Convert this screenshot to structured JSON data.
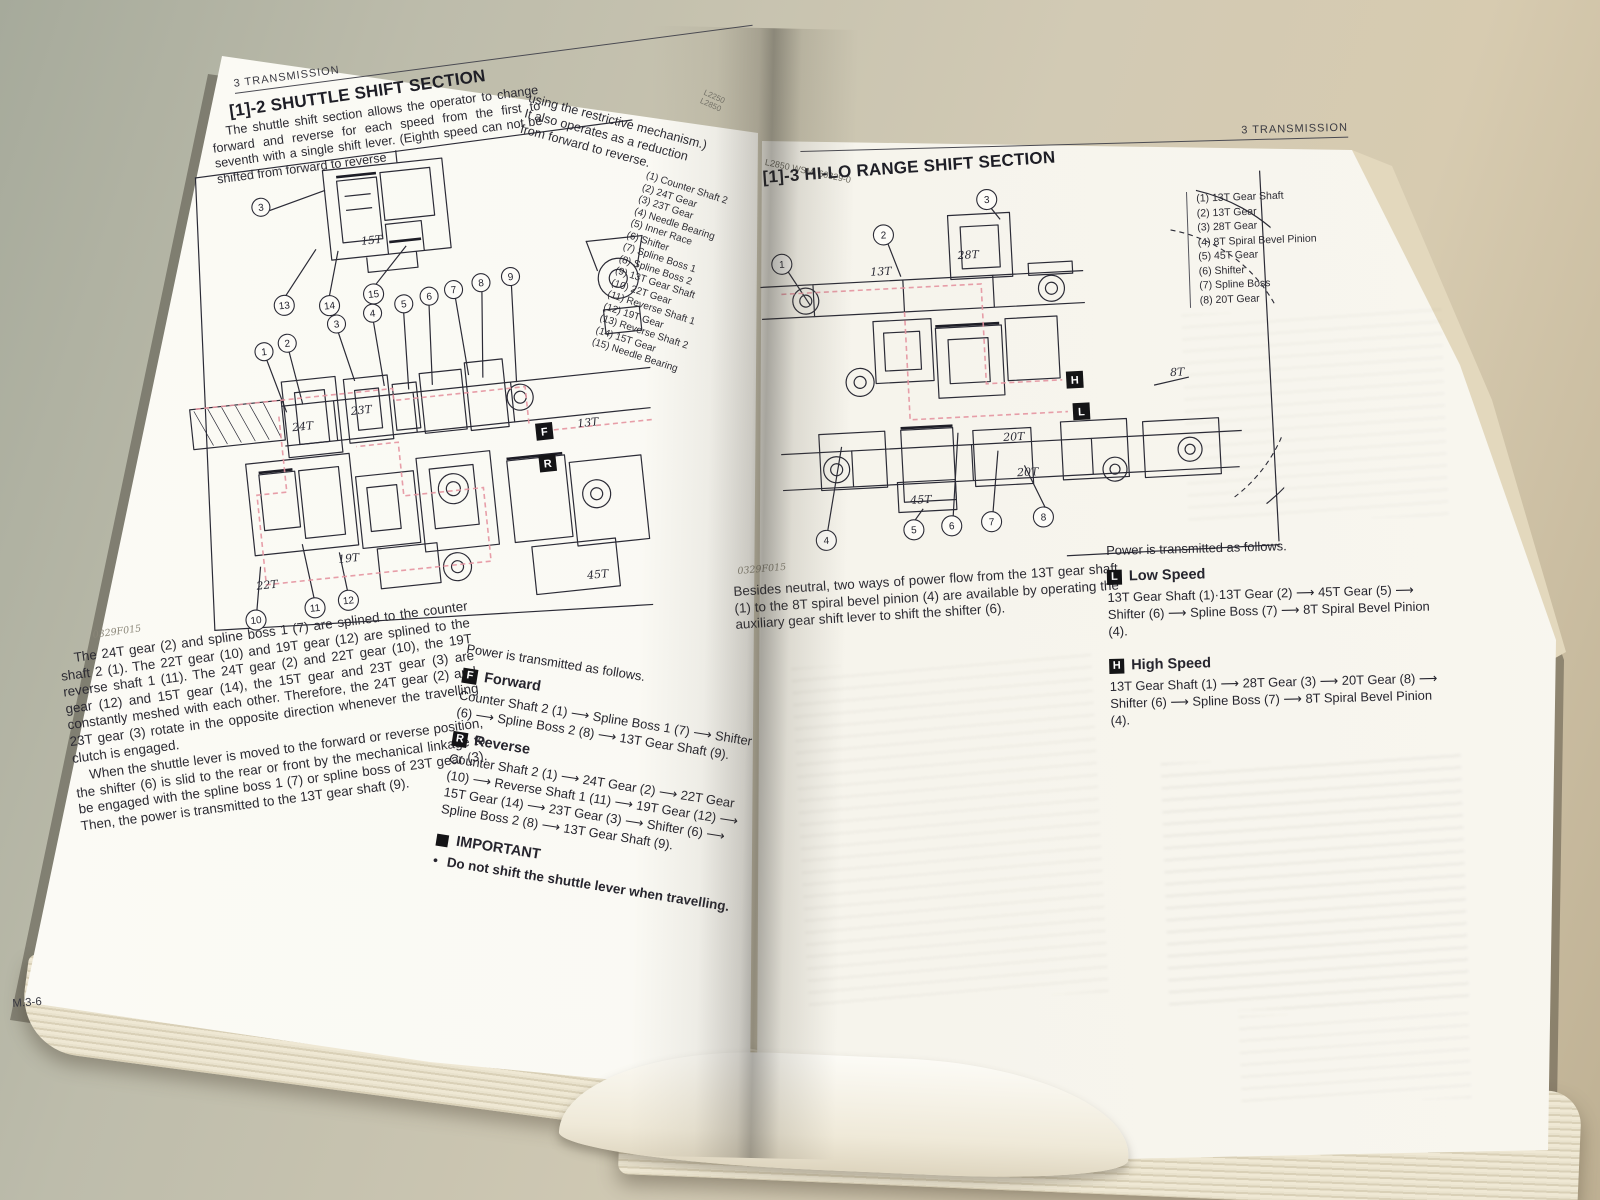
{
  "colors": {
    "table": "#c9c2af",
    "page": "#f8f6f0",
    "ink": "#2b2b36",
    "flow_red": "#e493a0",
    "badge_bg": "#141416"
  },
  "left_page": {
    "running_header": "3  TRANSMISSION",
    "section_title": "[1]-2 SHUTTLE SHIFT SECTION",
    "intro_col1": "The shuttle shift section allows the operator to change forward and reverse for each speed from the first to seventh with a single shift lever. (Eighth speed can not be shifted from forward to reverse",
    "intro_col2": "using the restrictive mechanism.)\nIt also operates as a reduction\nfrom forward to reverse.",
    "spine_fragment_1": "L2250",
    "spine_fragment_2": "L2850",
    "parts_list": [
      "(1)  Counter Shaft 2",
      "(2)  24T Gear",
      "(3)  23T Gear",
      "(4)  Needle Bearing",
      "(5)  Inner Race",
      "(6)  Shifter",
      "(7)  Spline Boss 1",
      "(8)  Spline Boss 2",
      "(9)  13T Gear Shaft",
      "(10)  22T Gear",
      "(11)  Reverse Shaft 1",
      "(12)  19T Gear",
      "(13)  Reverse Shaft 2",
      "(14)  15T Gear",
      "(15)  Needle Bearing"
    ],
    "body_p1": "The 24T gear (2) and spline boss 1 (7) are splined to the counter shaft 2 (1). The 22T gear (10) and 19T gear (12) are splined to the reverse shaft 1 (11). The 24T gear (2) and 22T gear (10), the 19T gear (12) and 15T gear (14), the 15T gear and 23T gear (3) are constantly meshed with each other. Therefore, the 24T gear (2) and 23T gear (3) rotate in the opposite direction whenever the travelling clutch is engaged.",
    "body_p2": "When the shuttle lever is moved to the forward or reverse position, the shifter (6) is slid to the rear or front by the mechanical linkage to be engaged with the spline boss 1 (7) or spline boss of 23T gear (3). Then, the power is transmitted to the 13T gear shaft (9).",
    "power_intro": "Power is transmitted as follows.",
    "forward": {
      "badge": "F",
      "title": "Forward",
      "chain": "Counter Shaft 2 (1) ⟶ Spline Boss 1 (7) ⟶ Shifter (6) ⟶ Spline Boss 2 (8) ⟶ 13T Gear Shaft (9)."
    },
    "reverse": {
      "badge": "R",
      "title": "Reverse",
      "chain": "Counter Shaft 2 (1) ⟶ 24T Gear (2) ⟶ 22T Gear (10) ⟶ Reverse Shaft 1 (11) ⟶ 19T Gear (12) ⟶ 15T Gear (14) ⟶ 23T Gear (3) ⟶ Shifter (6) ⟶ Spline Boss 2 (8) ⟶ 13T Gear Shaft (9)."
    },
    "important_title": "IMPORTANT",
    "important_bullet": "Do not shift the shuttle lever when travelling.",
    "figure_label": "0329F015",
    "page_number": "M.3-6",
    "diagram": {
      "callouts": [
        "1",
        "2",
        "3",
        "4",
        "5",
        "6",
        "7",
        "8",
        "9",
        "10",
        "11",
        "12",
        "13",
        "14",
        "15"
      ],
      "labels": {
        "g15": "15T",
        "g24": "24T",
        "g23": "23T",
        "g13": "13T",
        "g22": "22T",
        "g19": "19T",
        "g45": "45T"
      },
      "badge_f": "F",
      "badge_r": "R"
    }
  },
  "right_page": {
    "running_header": "L2850 WSM, 60329-0",
    "page_header": "3  TRANSMISSION",
    "section_title": "[1]-3 HI-LO RANGE SHIFT SECTION",
    "parts_list": [
      "(1)  13T Gear Shaft",
      "(2)  13T Gear",
      "(3)  28T Gear",
      "(4)  8T Spiral Bevel Pinion",
      "(5)  45T Gear",
      "(6)  Shifter",
      "(7)  Spline Boss",
      "(8)  20T Gear"
    ],
    "body_p1": "Besides neutral, two ways of power flow from the 13T gear shaft (1) to the 8T spiral bevel pinion (4) are available by operating the auxiliary gear shift lever to shift the shifter (6).",
    "power_intro": "Power is transmitted as follows.",
    "low": {
      "badge": "L",
      "title": "Low Speed",
      "chain": "13T Gear Shaft (1)·13T Gear (2) ⟶ 45T Gear (5) ⟶ Shifter (6) ⟶ Spline Boss (7) ⟶ 8T Spiral Bevel Pinion (4)."
    },
    "high": {
      "badge": "H",
      "title": "High Speed",
      "chain": "13T Gear Shaft (1) ⟶ 28T Gear (3) ⟶ 20T Gear (8) ⟶ Shifter (6) ⟶ Spline Boss (7) ⟶ 8T Spiral Bevel Pinion (4)."
    },
    "figure_label": "0329F015",
    "diagram": {
      "callouts": [
        "1",
        "2",
        "3",
        "4",
        "5",
        "6",
        "7",
        "8"
      ],
      "labels": {
        "g13": "13T",
        "g28": "28T",
        "g8": "8T",
        "g20a": "20T",
        "g20b": "20T",
        "g45": "45T"
      },
      "badge_h": "H",
      "badge_l": "L"
    }
  }
}
